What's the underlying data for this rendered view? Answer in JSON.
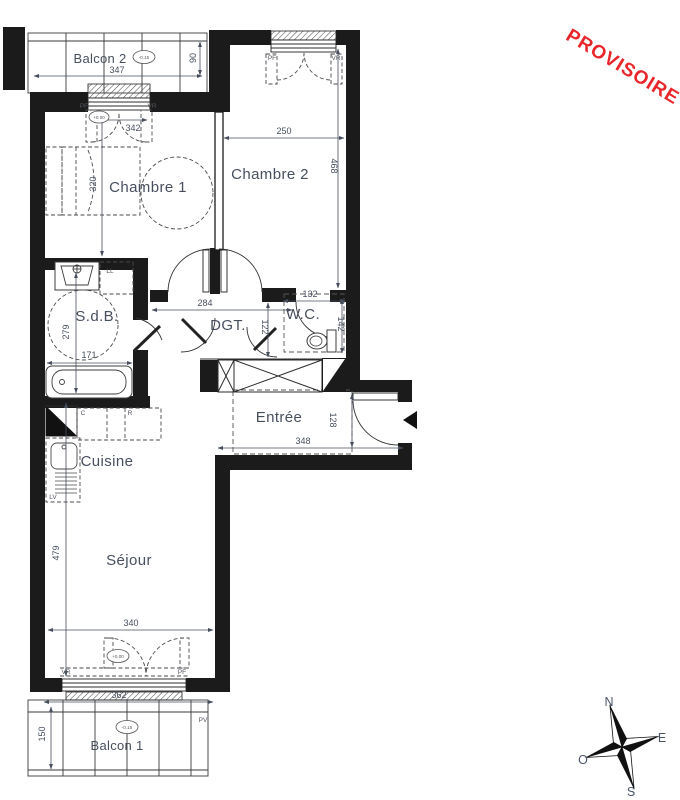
{
  "stamp": {
    "text": "PROVISOIRE"
  },
  "colors": {
    "stamp": "#e8252b",
    "ink": "#1b1b1b",
    "label": "#474f5e"
  },
  "rooms": {
    "balcon2": "Balcon 2",
    "chambre1": "Chambre 1",
    "chambre2": "Chambre 2",
    "sdb": "S.d.B.",
    "dgt": "DGT.",
    "wc": "W.C.",
    "entree": "Entrée",
    "cuisine": "Cuisine",
    "sejour": "Séjour",
    "balcon1": "Balcon 1"
  },
  "dims": {
    "balcon2_width": "347",
    "balcon2_depth": "90",
    "chambre1_window": "342",
    "chambre1_depth": "320",
    "chambre2_width": "250",
    "chambre2_depth": "468",
    "sdb_depth": "279",
    "sdb_width": "171",
    "dgt_width": "284",
    "dgt_depth": "122",
    "wc_width": "132",
    "wc_depth": "142",
    "entree_width": "348",
    "entree_depth": "128",
    "sejour_depth": "479",
    "sejour_width": "340",
    "balcon1_width": "362",
    "balcon1_depth": "150"
  },
  "levels": {
    "balcon2": "-0.15",
    "chambre1_door": "+0.00",
    "sejour_door": "+0.00",
    "balcon1": "-0.15"
  },
  "tags": {
    "pf": "PF",
    "vr": "VR",
    "pv": "PV",
    "ll": "LL",
    "lv": "LV",
    "c": "C",
    "r": "R"
  },
  "compass": {
    "n": "N",
    "e": "E",
    "s": "S",
    "o": "O"
  }
}
